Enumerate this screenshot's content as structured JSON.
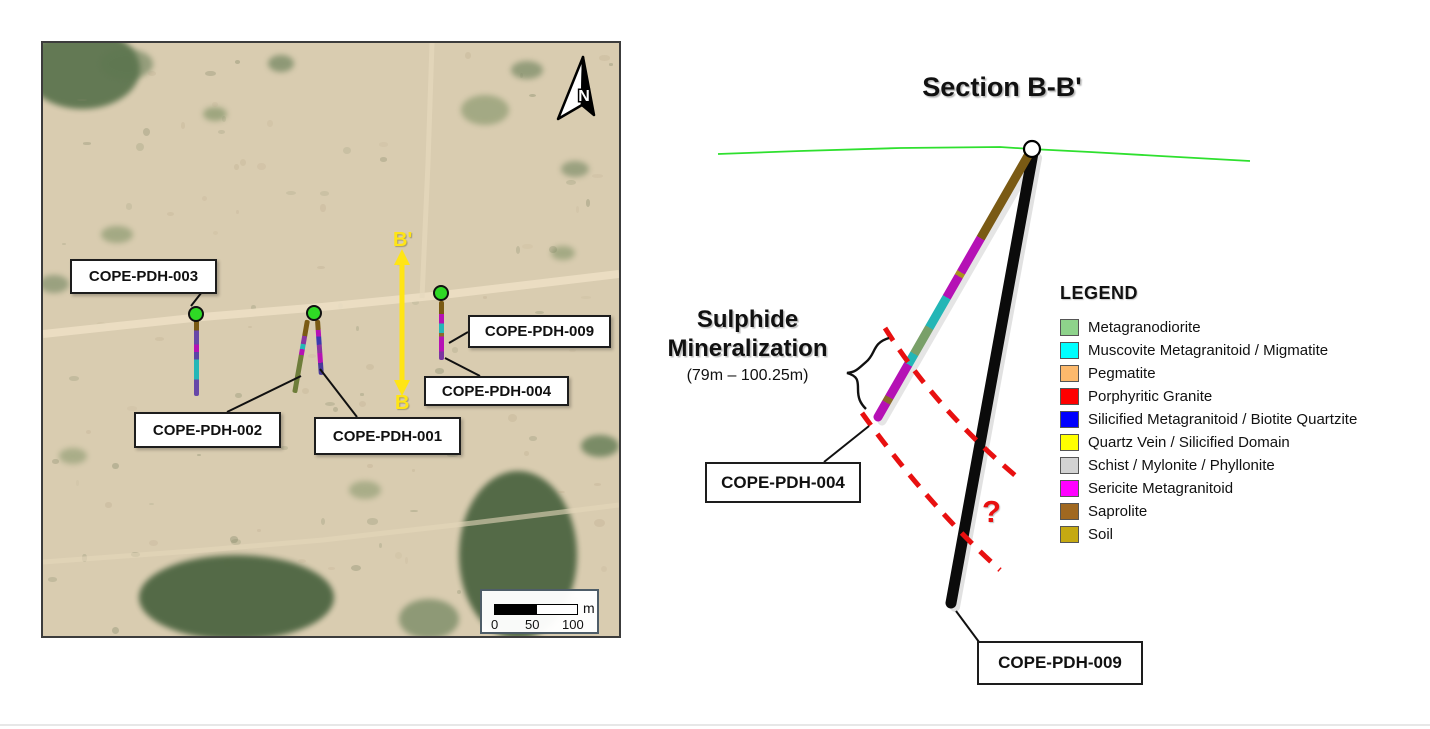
{
  "map": {
    "north_label": "N",
    "section_line": {
      "start_label": "B'",
      "end_label": "B"
    },
    "holes": [
      {
        "label": "COPE-PDH-003"
      },
      {
        "label": "COPE-PDH-002"
      },
      {
        "label": "COPE-PDH-001"
      },
      {
        "label": "COPE-PDH-009"
      },
      {
        "label": "COPE-PDH-004"
      }
    ],
    "scale": {
      "unit": "m",
      "ticks": [
        "0",
        "50",
        "100"
      ]
    }
  },
  "section": {
    "title": "Section B-B'",
    "annotation": {
      "line1": "Sulphide",
      "line2": "Mineralization",
      "interval": "(79m – 100.25m)"
    },
    "question_mark": "?",
    "labels": {
      "pdh004": "COPE-PDH-004",
      "pdh009": "COPE-PDH-009"
    },
    "legend": {
      "title": "LEGEND",
      "items": [
        {
          "label": "Metagranodiorite",
          "color": "#8ed38b"
        },
        {
          "label": "Muscovite Metagranitoid / Migmatite",
          "color": "#00ffff"
        },
        {
          "label": "Pegmatite",
          "color": "#fcb96c"
        },
        {
          "label": "Porphyritic Granite",
          "color": "#fe0000"
        },
        {
          "label": "Silicified Metagranitoid / Biotite Quartzite",
          "color": "#0000fe"
        },
        {
          "label": "Quartz Vein / Silicified Domain",
          "color": "#ffff00"
        },
        {
          "label": "Schist / Mylonite / Phyllonite",
          "color": "#d2d2d2"
        },
        {
          "label": "Sericite Metagranitoid",
          "color": "#ff00ff"
        },
        {
          "label": "Saprolite",
          "color": "#a06820"
        },
        {
          "label": "Soil",
          "color": "#c5a912"
        }
      ]
    },
    "colors": {
      "mineralization_dash": "#e81010",
      "topo_line": "#2ee02e",
      "hole_trace": "#0b0b0b"
    }
  }
}
